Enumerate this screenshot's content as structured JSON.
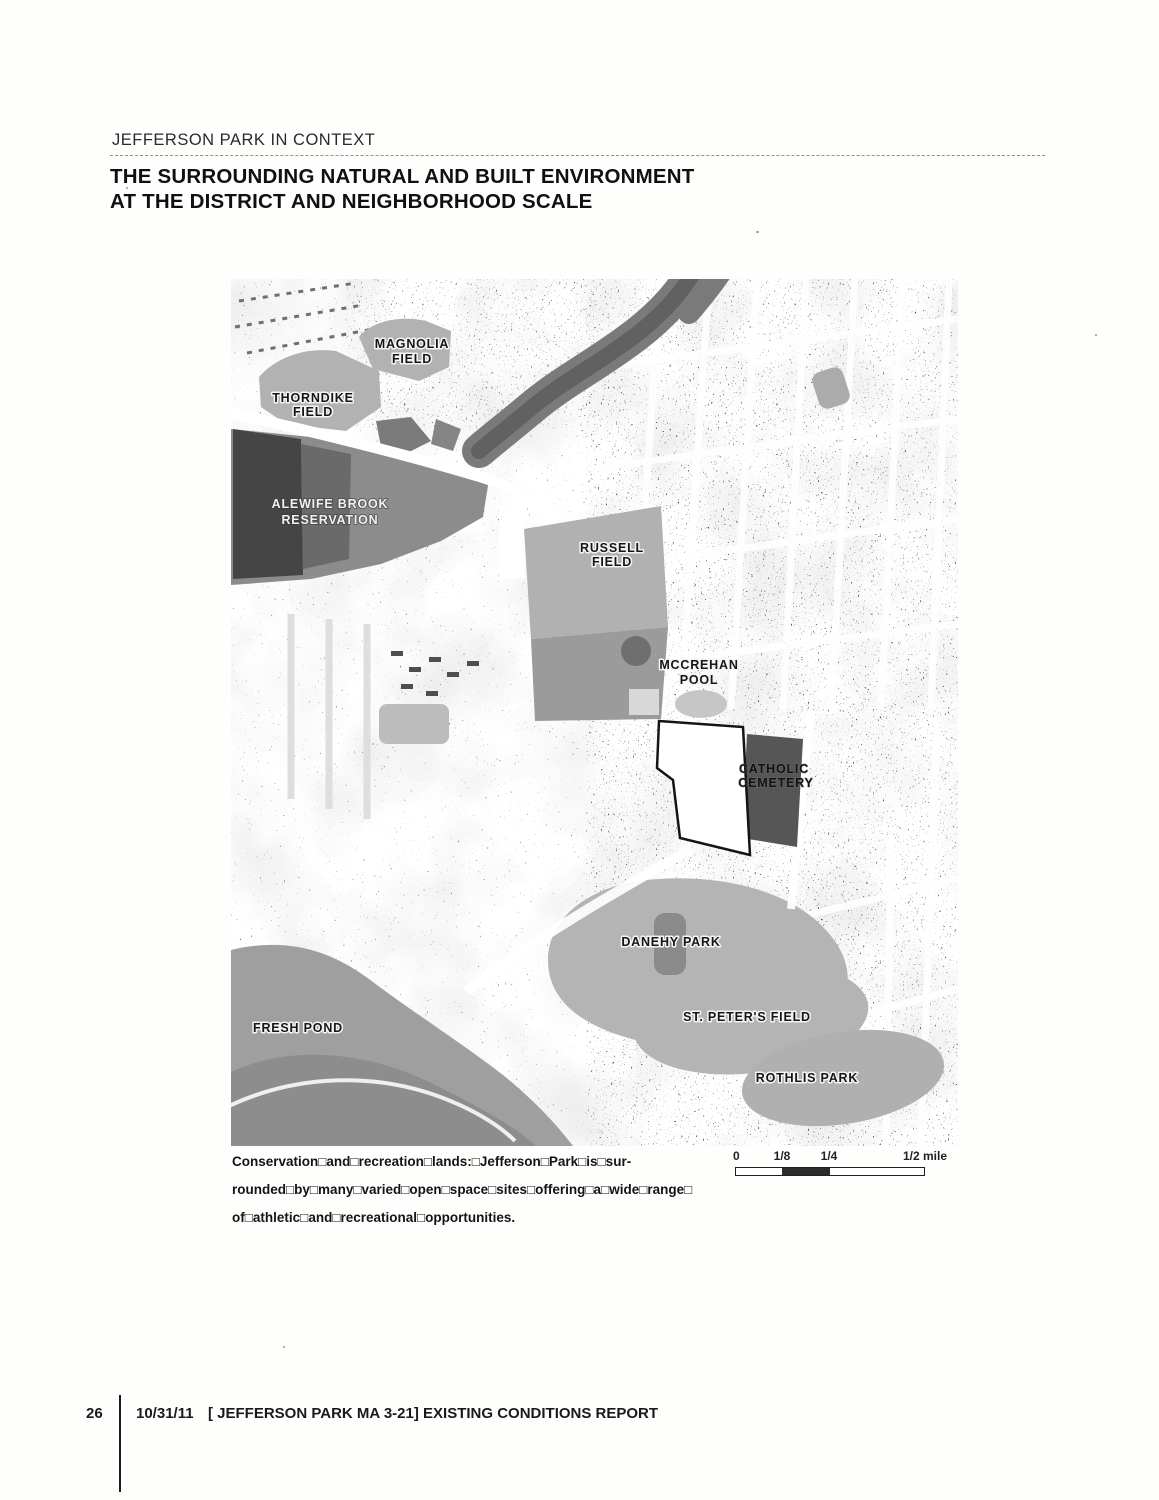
{
  "header": {
    "eyebrow": "JEFFERSON PARK IN CONTEXT",
    "title_line1": "THE SURROUNDING NATURAL AND BUILT ENVIRONMENT",
    "title_line2": "AT THE DISTRICT AND NEIGHBORHOOD SCALE"
  },
  "map": {
    "region_labels": [
      {
        "name": "Magnolia Field",
        "lines": [
          "MAGNOLIA",
          "FIELD"
        ]
      },
      {
        "name": "Thorndike Field",
        "lines": [
          "THORNDIKE",
          "FIELD"
        ]
      },
      {
        "name": "Alewife Brook Reservation",
        "lines": [
          "ALEWIFE BROOK",
          "RESERVATION"
        ]
      },
      {
        "name": "Russell Field",
        "lines": [
          "RUSSELL",
          "FIELD"
        ]
      },
      {
        "name": "McCrehan Pool",
        "lines": [
          "MCCREHAN",
          "POOL"
        ]
      },
      {
        "name": "Catholic Cemetery",
        "lines": [
          "CATHOLIC",
          "CEMETERY"
        ]
      },
      {
        "name": "Danehy Park",
        "lines": [
          "DANEHY PARK"
        ]
      },
      {
        "name": "St. Peter's Field",
        "lines": [
          "ST. PETER'S FIELD"
        ]
      },
      {
        "name": "Rothlis Park",
        "lines": [
          "ROTHLIS PARK"
        ]
      },
      {
        "name": "Fresh Pond",
        "lines": [
          "FRESH POND"
        ]
      }
    ]
  },
  "caption": {
    "lead": "Conservation□and□recreation□lands:",
    "line1_rest": "□Jefferson□Park□is□sur-",
    "line2": "rounded□by□many□varied□open□space□sites□offering□a□wide□range□",
    "line3": "of□athletic□and□recreational□opportunities."
  },
  "scale_bar": {
    "ticks": [
      "0",
      "1/8",
      "1/4",
      "1/2 mile"
    ]
  },
  "footer": {
    "page_number": "26",
    "date": "10/31/11",
    "report_title": "[ JEFFERSON PARK MA 3-21] EXISTING CONDITIONS REPORT"
  },
  "colors": {
    "ink": "#1a1a1a",
    "map_open_space_gray": "#b2b2b2",
    "map_dark_area": "#4a4a4a",
    "cemetery_fill": "#565656"
  }
}
